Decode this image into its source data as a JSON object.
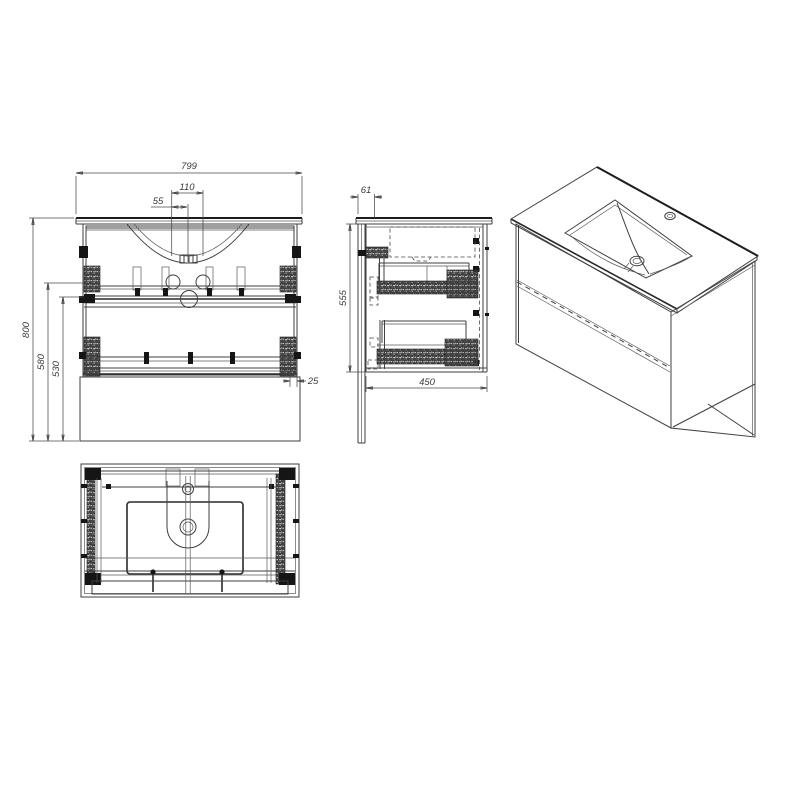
{
  "drawing_type": "bathroom-vanity-technical-drawing",
  "dims": {
    "front_width": "799",
    "tap_spacing": "110",
    "tap_half": "55",
    "total_height": "800",
    "height_580": "580",
    "height_530": "530",
    "offset_25": "25",
    "side_inset": "61",
    "side_height": "555",
    "depth_450": "450"
  },
  "colors": {
    "line": "#3f3f3f",
    "dark": "#1d1d1d",
    "background": "#ffffff"
  }
}
